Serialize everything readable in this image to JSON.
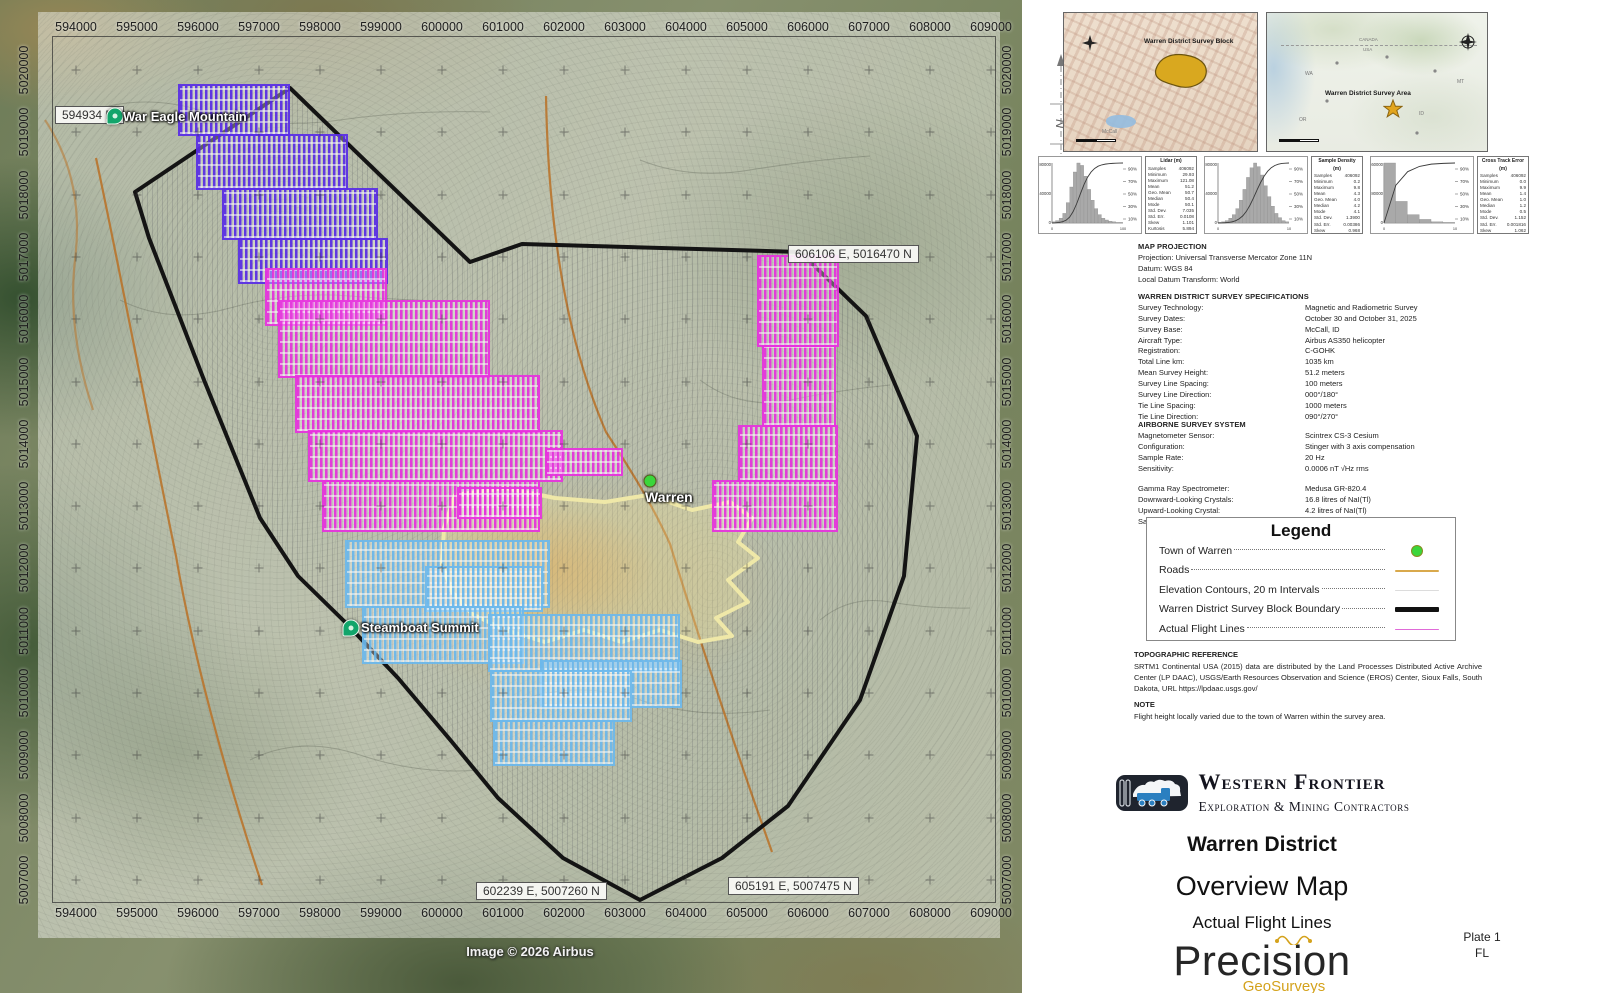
{
  "map": {
    "credit": "Image © 2026 Airbus",
    "eastings": [
      "594000",
      "595000",
      "596000",
      "597000",
      "598000",
      "599000",
      "600000",
      "601000",
      "602000",
      "603000",
      "604000",
      "605000",
      "606000",
      "607000",
      "608000",
      "609000"
    ],
    "northings": [
      "5020000",
      "5019000",
      "5018000",
      "5017000",
      "5016000",
      "5015000",
      "5014000",
      "5013000",
      "5012000",
      "5011000",
      "5010000",
      "5009000",
      "5008000",
      "5007000"
    ],
    "callouts": [
      {
        "text": "594934 E,",
        "x": 55,
        "y": 106
      },
      {
        "text": "606106 E, 5016470 N",
        "x": 788,
        "y": 245
      },
      {
        "text": "602239 E, 5007260 N",
        "x": 476,
        "y": 882
      },
      {
        "text": "605191 E, 5007475 N",
        "x": 728,
        "y": 877
      }
    ],
    "places": [
      {
        "label": "War Eagle Mountain",
        "type": "pin",
        "px": 115,
        "py": 116,
        "lx": 123,
        "ly": 109
      },
      {
        "label": "Steamboat Summit",
        "type": "pin",
        "px": 351,
        "py": 628,
        "lx": 361,
        "ly": 620
      },
      {
        "label": "Warren",
        "type": "dot",
        "px": 650,
        "py": 481,
        "lx": 645,
        "ly": 489
      }
    ],
    "colors": {
      "purple": "#5a2ee6",
      "magenta": "#e733de",
      "blue": "#6db9ec",
      "boundary": "#141414",
      "exclusion": "#efe8a8",
      "road": "#b9742c",
      "town_dot": "#3bd63b"
    },
    "flight_blocks": [
      {
        "color": "purple",
        "rects": [
          [
            178,
            84,
            112,
            52
          ],
          [
            196,
            134,
            152,
            56
          ],
          [
            222,
            188,
            156,
            52
          ],
          [
            238,
            238,
            150,
            46
          ]
        ]
      },
      {
        "color": "magenta",
        "rects": [
          [
            265,
            268,
            122,
            58
          ],
          [
            278,
            300,
            212,
            78
          ],
          [
            295,
            375,
            245,
            58
          ],
          [
            308,
            430,
            255,
            52
          ],
          [
            322,
            480,
            218,
            52
          ],
          [
            545,
            448,
            78,
            28
          ],
          [
            457,
            487,
            85,
            32
          ],
          [
            757,
            255,
            82,
            92
          ],
          [
            762,
            345,
            74,
            82
          ],
          [
            738,
            425,
            100,
            57
          ],
          [
            712,
            480,
            126,
            52
          ]
        ]
      },
      {
        "color": "blue",
        "rects": [
          [
            345,
            540,
            205,
            68
          ],
          [
            425,
            566,
            118,
            46
          ],
          [
            362,
            606,
            162,
            58
          ],
          [
            488,
            614,
            192,
            58
          ],
          [
            540,
            660,
            142,
            48
          ],
          [
            490,
            670,
            142,
            52
          ],
          [
            493,
            720,
            122,
            46
          ]
        ]
      }
    ],
    "boundary_points": "290,88 470,262 522,244 800,252 866,316 917,436 904,576 860,700 788,806 722,858 640,900 563,858 498,798 452,742 398,678 345,622 298,576 260,518 204,380 149,238 135,192",
    "exclusion_path": "M455,495 L505,488 L555,498 L605,502 L648,495 L692,510 L730,502 L752,518 L738,542 L758,558 L728,580 L748,602 L716,618 L732,636 L698,642 L660,630 L622,642 L584,630 L545,642 L505,630 L472,614 L452,592 L442,564 L444,528 Z"
  },
  "north_arrow_label": "N",
  "insets": {
    "block_map": {
      "label": "Warren District Survey Block",
      "lake_label": "McCall"
    },
    "area_map": {
      "label": "Warren District Survey Area",
      "country_top": "CANADA",
      "country_bottom": "USA",
      "states": [
        {
          "t": "WA",
          "x": 38,
          "y": 58
        },
        {
          "t": "MT",
          "x": 190,
          "y": 66
        },
        {
          "t": "OR",
          "x": 32,
          "y": 104
        },
        {
          "t": "ID",
          "x": 152,
          "y": 98
        }
      ]
    }
  },
  "histograms": [
    {
      "title": "Lidar (m)",
      "y_ticks": [
        "80000",
        "40000",
        "0"
      ],
      "x_ticks": [
        "0",
        "100"
      ],
      "pct_ticks": [
        "90%",
        "70%",
        "50%",
        "30%",
        "10%"
      ],
      "bars": [
        2,
        4,
        8,
        16,
        34,
        60,
        85,
        100,
        96,
        78,
        56,
        38,
        24,
        14,
        8,
        5,
        3,
        2,
        1,
        1
      ],
      "stats": [
        [
          "Samples",
          "406092"
        ],
        [
          "Minimum",
          "29.93"
        ],
        [
          "Maximum",
          "121.08"
        ],
        [
          "Mean",
          "51.2"
        ],
        [
          "Geo. Mean",
          "50.7"
        ],
        [
          "Median",
          "50.4"
        ],
        [
          "Mode",
          "50.1"
        ],
        [
          "Std. Dev.",
          "7.035"
        ],
        [
          "Std. Err.",
          "0.0108"
        ],
        [
          "Skew",
          "1.101"
        ],
        [
          "Kurtosis",
          "5.894"
        ]
      ]
    },
    {
      "title": "Sample Density (m)",
      "y_ticks": [
        "80000",
        "40000",
        "0"
      ],
      "x_ticks": [
        "0",
        "10"
      ],
      "pct_ticks": [
        "90%",
        "70%",
        "50%",
        "30%",
        "10%"
      ],
      "bars": [
        1,
        2,
        4,
        8,
        14,
        24,
        38,
        56,
        76,
        92,
        100,
        94,
        80,
        62,
        44,
        28,
        16,
        9,
        4,
        2
      ],
      "stats": [
        [
          "Samples",
          "406092"
        ],
        [
          "Minimum",
          "0.2"
        ],
        [
          "Maximum",
          "9.8"
        ],
        [
          "Mean",
          "4.3"
        ],
        [
          "Geo. Mean",
          "4.0"
        ],
        [
          "Median",
          "4.2"
        ],
        [
          "Mode",
          "4.1"
        ],
        [
          "Std. Dev.",
          "1.3900"
        ],
        [
          "Std. Err.",
          "0.00386"
        ],
        [
          "Skew",
          "0.968"
        ],
        [
          "Kurtosis",
          "0.5719"
        ]
      ]
    },
    {
      "title": "Cross Track Error (m)",
      "y_ticks": [
        "160000",
        "80000",
        "0"
      ],
      "x_ticks": [
        "0",
        "10"
      ],
      "pct_ticks": [
        "90%",
        "70%",
        "50%",
        "30%",
        "10%"
      ],
      "bars": [
        100,
        36,
        14,
        6,
        2,
        1
      ],
      "stats": [
        [
          "Samples",
          "406092"
        ],
        [
          "Minimum",
          "0.0"
        ],
        [
          "Maximum",
          "9.9"
        ],
        [
          "Mean",
          "1.4"
        ],
        [
          "Geo. Mean",
          "1.0"
        ],
        [
          "Median",
          "1.2"
        ],
        [
          "Mode",
          "0.5"
        ],
        [
          "Std. Dev.",
          "1.152"
        ],
        [
          "Std. Err.",
          "0.001816"
        ],
        [
          "Skew",
          "1.062"
        ],
        [
          "Kurtosis",
          "1.254"
        ]
      ]
    }
  ],
  "panel": {
    "projection": {
      "heading": "MAP PROJECTION",
      "lines": [
        "Projection: Universal Transverse Mercator Zone 11N",
        "Datum: WGS 84",
        "Local Datum Transform: World"
      ]
    },
    "specs": {
      "heading": "WARREN DISTRICT SURVEY SPECIFICATIONS",
      "rows": [
        [
          "Survey Technology:",
          "Magnetic and Radiometric Survey"
        ],
        [
          "Survey Dates:",
          "October 30 and October 31, 2025"
        ],
        [
          "Survey Base:",
          "McCall, ID"
        ],
        [
          "Aircraft Type:",
          "Airbus AS350 helicopter"
        ],
        [
          "Registration:",
          "C-GOHK"
        ],
        [
          "Total Line km:",
          "1035 km"
        ],
        [
          "Mean Survey Height:",
          "51.2 meters"
        ],
        [
          "Survey Line Spacing:",
          "100 meters"
        ],
        [
          "Survey Line Direction:",
          "000°/180°"
        ],
        [
          "Tie Line Spacing:",
          "1000 meters"
        ],
        [
          "Tie Line Direction:",
          "090°/270°"
        ]
      ]
    },
    "airborne": {
      "heading": "AIRBORNE SURVEY SYSTEM",
      "rows1": [
        [
          "Magnetometer Sensor:",
          "Scintrex CS-3 Cesium"
        ],
        [
          "Configuration:",
          "Stinger with 3 axis compensation"
        ],
        [
          "Sample Rate:",
          "20 Hz"
        ],
        [
          "Sensitivity:",
          "0.0006 nT √Hz rms"
        ]
      ],
      "rows2": [
        [
          "Gamma Ray Spectrometer:",
          "Medusa GR-820.4"
        ],
        [
          "Downward-Looking Crystals:",
          "16.8 litres of NaI(Tl)"
        ],
        [
          "Upward-Looking Crystal:",
          "4.2 litres of NaI(Tl)"
        ],
        [
          "Sample Rate:",
          "1 Hz"
        ]
      ]
    },
    "legend": {
      "title": "Legend",
      "rows": [
        {
          "label": "Town of Warren",
          "symbol": "town-dot"
        },
        {
          "label": "Roads",
          "symbol": "road-line"
        },
        {
          "label": "Elevation Contours, 20 m Intervals",
          "symbol": "contour-line"
        },
        {
          "label": "Warren District Survey Block Boundary",
          "symbol": "boundary-line"
        },
        {
          "label": "Actual Flight Lines",
          "symbol": "flight-line"
        }
      ]
    },
    "topo": {
      "heading": "TOPOGRAPHIC REFERENCE",
      "text": "SRTM1 Continental USA (2015) data are distributed by the Land Processes Distributed Active Archive Center (LP DAAC), USGS/Earth Resources Observation and Science (EROS) Center, Sioux Falls, South Dakota, URL https://lpdaac.usgs.gov/"
    },
    "note": {
      "heading": "NOTE",
      "text": "Flight height locally varied due to the town of Warren within the survey area."
    }
  },
  "branding": {
    "company": "Western Frontier",
    "company_sub": "Exploration & Mining Contractors",
    "title1": "Warren District",
    "title2": "Overview Map",
    "title3": "Actual Flight Lines",
    "surveyor": "Precision",
    "surveyor_sub": "GeoSurveys",
    "plate": "Plate 1",
    "plate_code": "FL"
  }
}
